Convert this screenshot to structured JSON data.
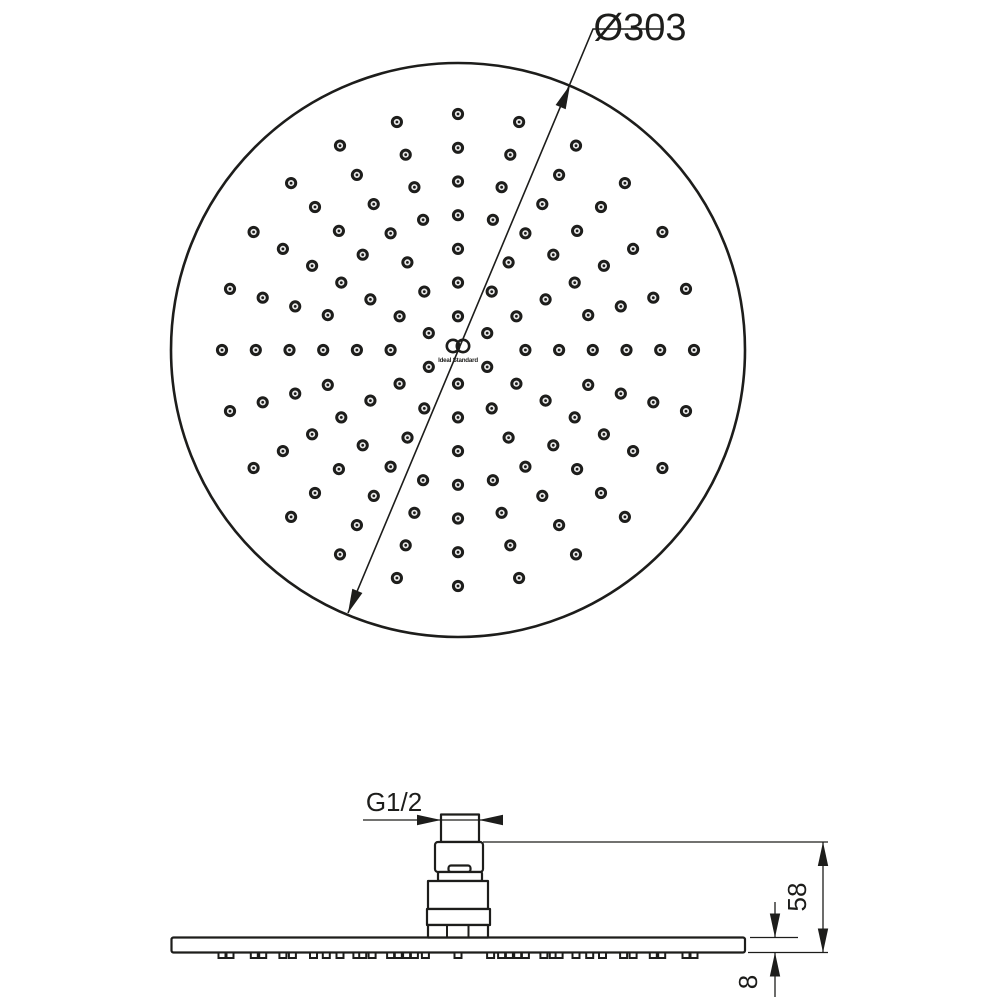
{
  "drawing": {
    "labels": {
      "diameter": "Ø303",
      "thread": "G1/2",
      "height": "58",
      "thickness": "8"
    },
    "logo": {
      "brand": "Ideal Standard"
    },
    "colors": {
      "line": "#1d1d1b",
      "background": "#ffffff",
      "dot_center": "#e9e9e9"
    },
    "top_view": {
      "center": {
        "x": 458,
        "y": 350
      },
      "face_radius_px": 287,
      "nozzle_rings": [
        {
          "radius_px": 33.7,
          "count": 6,
          "start_deg": -90
        },
        {
          "radius_px": 67.4,
          "count": 12,
          "start_deg": -90
        },
        {
          "radius_px": 101.1,
          "count": 12,
          "start_deg": -90
        },
        {
          "radius_px": 134.8,
          "count": 24,
          "start_deg": -90
        },
        {
          "radius_px": 168.5,
          "count": 24,
          "start_deg": -90
        },
        {
          "radius_px": 202.2,
          "count": 24,
          "start_deg": -90
        },
        {
          "radius_px": 236.0,
          "count": 24,
          "start_deg": -90
        }
      ],
      "dot_outer_radius": 4.6,
      "dot_core_radius": 1.4
    },
    "side_view": {
      "disc": {
        "x": 171.5,
        "y": 937.5,
        "width": 573.5,
        "height": 15
      },
      "nozzle_mark": {
        "width": 7,
        "height": 5.5,
        "y": 952.5,
        "merge_px": 5
      }
    }
  }
}
